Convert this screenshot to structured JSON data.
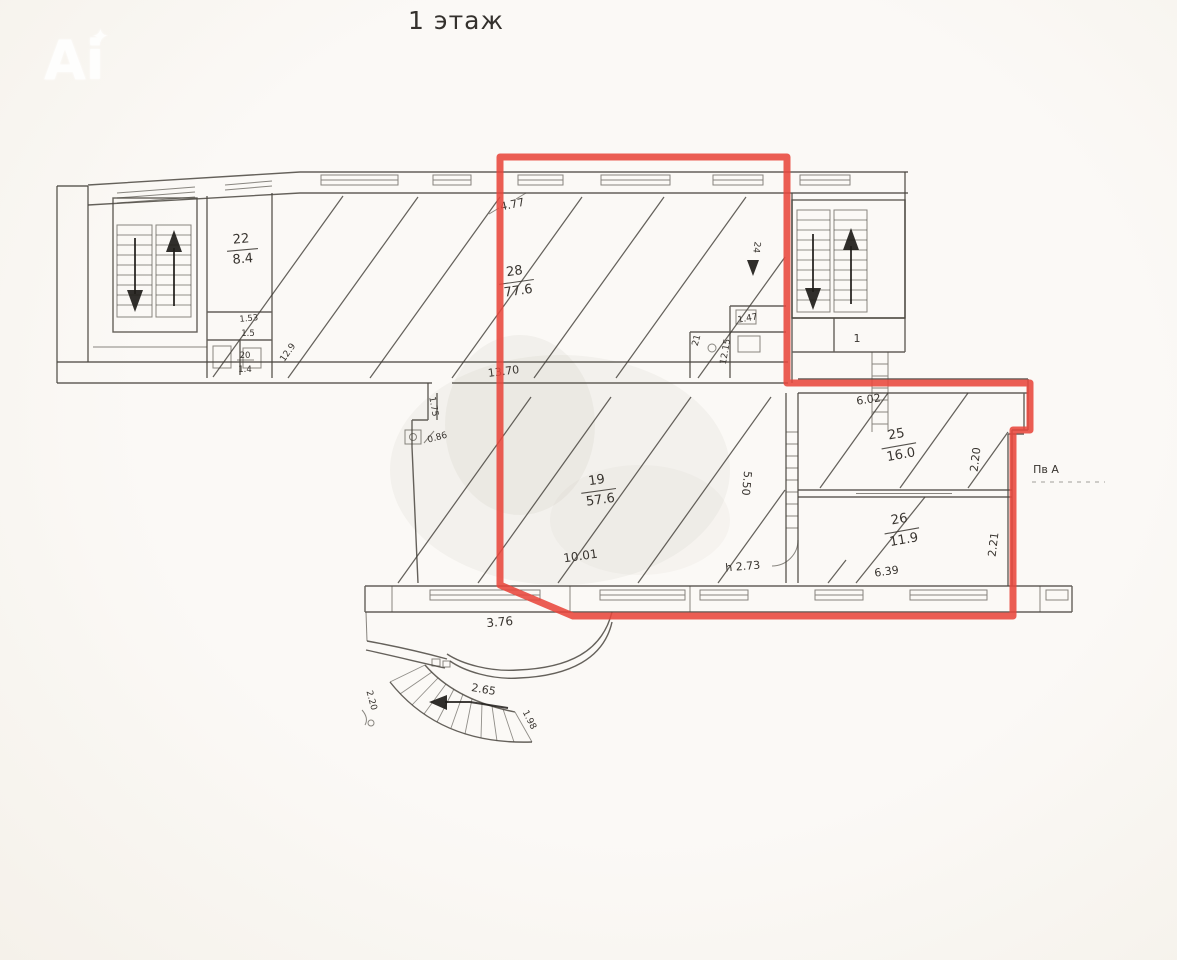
{
  "page": {
    "title": "1 этаж"
  },
  "watermark": {
    "text": "Ai",
    "star": "✦"
  },
  "colors": {
    "highlight_red": "#e8473c",
    "ink": "#4a463f",
    "paper": "#f7f4ef"
  },
  "rooms": [
    {
      "number": "22",
      "area": "8.4"
    },
    {
      "number": "28",
      "area": "77.6"
    },
    {
      "number": "19",
      "area": "57.6"
    },
    {
      "number": "25",
      "area": "16.0"
    },
    {
      "number": "26",
      "area": "11.9"
    }
  ],
  "stair_unit_label": "1",
  "liter_label": "Пв А",
  "dims": {
    "top_width": "4.77",
    "door_24": "24",
    "wc_width": "1.47",
    "wc_depth": "12.15",
    "wc_small": "21",
    "corridor_len": "13.70",
    "room25_top": "6.02",
    "room19_right": "5.50",
    "ceiling_h": "h 2.73",
    "room19_bottom": "10.01",
    "room26_bottom": "6.39",
    "room25_side": "2.20",
    "room26_side": "2.21",
    "porch_width": "3.76",
    "stair_arc": "2.65",
    "stair_end": "1.98",
    "porch_left": "2.20",
    "notch_door": "0.86",
    "notch_side": "1.75",
    "wc1": "1.53",
    "wc2": "1.5",
    "wc3": "20",
    "wc4": "1.4",
    "wc5": "12.9"
  }
}
